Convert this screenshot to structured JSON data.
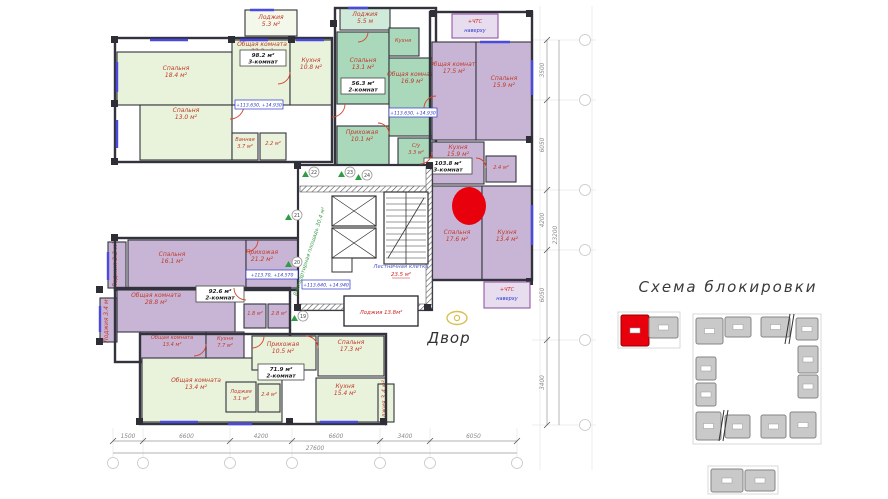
{
  "palette": {
    "pale_green": "#e9f2da",
    "teal": "#a9d8bb",
    "yellow": "#ffd355",
    "purple": "#c8b5d5",
    "wall": "#33333d",
    "label_red": "#c03a2b",
    "blue_note": "#2a35c9",
    "dim_gray": "#8a8a8a",
    "marker_red": "#e8000d",
    "block_gray": "#c9c9c9",
    "block_border": "#858585",
    "window_blue": "#4a4ae0",
    "door_red": "#d4452c",
    "green_arrow": "#2e9e44",
    "eye_yellow": "#d8c050"
  },
  "scheme": {
    "title": "Схема блокировки"
  },
  "courtyard": {
    "label": "Двор"
  },
  "floorplan": {
    "apartments": [
      {
        "id": "98-2",
        "color": "pale_green",
        "ox": 115,
        "oy": 38,
        "ow": 217,
        "oh": 124,
        "info": {
          "area": "98.2 м²",
          "type": "3-комнат",
          "x": 240,
          "y": 50,
          "w": 46,
          "h": 16
        },
        "rooms": [
          {
            "name": "Спальня",
            "area": "18.4 м²",
            "x": 117,
            "y": 52,
            "w": 115,
            "h": 53,
            "lx": 176,
            "ly": 70
          },
          {
            "name": "Общая комната",
            "area": "23.2 м²",
            "x": 232,
            "y": 40,
            "w": 58,
            "h": 65,
            "lx": 262,
            "ly": 46
          },
          {
            "name": "Кухня",
            "area": "10.8 м²",
            "x": 290,
            "y": 40,
            "w": 42,
            "h": 65,
            "lx": 311,
            "ly": 62
          },
          {
            "name": "Спальня",
            "area": "13.0 м²",
            "x": 140,
            "y": 105,
            "w": 92,
            "h": 55,
            "lx": 186,
            "ly": 112
          },
          {
            "name": "Ванная",
            "area": "3.7 м²",
            "x": 232,
            "y": 133,
            "w": 26,
            "h": 27,
            "lx": 245,
            "ly": 141,
            "small": true
          },
          {
            "name": "",
            "area": "2.2 м²",
            "x": 260,
            "y": 133,
            "w": 26,
            "h": 27,
            "lx": 273,
            "ly": 142,
            "small": true
          },
          {
            "name": "Лоджия",
            "area": "5.3 м²",
            "x": 245,
            "y": 10,
            "w": 52,
            "h": 26,
            "lx": 271,
            "ly": 19,
            "light": true
          }
        ]
      },
      {
        "id": "56-3",
        "color": "teal",
        "ox": 335,
        "oy": 8,
        "ow": 101,
        "oh": 159,
        "info": {
          "area": "56.3 м²",
          "type": "2-комнат",
          "x": 341,
          "y": 78,
          "w": 44,
          "h": 16
        },
        "rooms": [
          {
            "name": "Лоджия",
            "area": "5.5 м",
            "x": 340,
            "y": 8,
            "w": 50,
            "h": 22,
            "lx": 365,
            "ly": 16,
            "light": true
          },
          {
            "name": "Спальня",
            "area": "13.1 м²",
            "x": 337,
            "y": 32,
            "w": 52,
            "h": 72,
            "lx": 363,
            "ly": 62
          },
          {
            "name": "Кухня",
            "area": "",
            "x": 389,
            "y": 28,
            "w": 30,
            "h": 28,
            "lx": 403,
            "ly": 42,
            "small": true
          },
          {
            "name": "Общая комната",
            "area": "16.9 м²",
            "x": 389,
            "y": 58,
            "w": 47,
            "h": 78,
            "lx": 412,
            "ly": 76
          },
          {
            "name": "Прихожая",
            "area": "10.1 м²",
            "x": 337,
            "y": 126,
            "w": 52,
            "h": 40,
            "lx": 362,
            "ly": 134
          },
          {
            "name": "С/у",
            "area": "3.3 м²",
            "x": 398,
            "y": 138,
            "w": 38,
            "h": 28,
            "lx": 416,
            "ly": 147,
            "small": true
          }
        ]
      },
      {
        "id": "103-8",
        "color": "purple",
        "ox": 430,
        "oy": 12,
        "ow": 102,
        "oh": 268,
        "info": {
          "area": "103.8 м²",
          "type": "3-комнат",
          "x": 424,
          "y": 158,
          "w": 48,
          "h": 16
        },
        "rooms": [
          {
            "name": "Общая комната",
            "area": "17.5 м²",
            "x": 432,
            "y": 42,
            "w": 44,
            "h": 98,
            "lx": 454,
            "ly": 66
          },
          {
            "name": "Спальня",
            "area": "15.9 м²",
            "x": 476,
            "y": 42,
            "w": 56,
            "h": 98,
            "lx": 504,
            "ly": 80
          },
          {
            "name": "Кухня",
            "area": "15.9 м²",
            "x": 432,
            "y": 142,
            "w": 52,
            "h": 42,
            "lx": 458,
            "ly": 149
          },
          {
            "name": "",
            "area": "2.4 м²",
            "x": 486,
            "y": 156,
            "w": 30,
            "h": 26,
            "lx": 501,
            "ly": 166,
            "small": true
          },
          {
            "name": "Спальня",
            "area": "17.6 м²",
            "x": 432,
            "y": 186,
            "w": 50,
            "h": 94,
            "lx": 457,
            "ly": 234
          },
          {
            "name": "Кухня",
            "area": "13.4 м²",
            "x": 482,
            "y": 186,
            "w": 50,
            "h": 94,
            "lx": 507,
            "ly": 234
          }
        ]
      },
      {
        "id": "e-strip",
        "color": "purple",
        "ox": 115,
        "oy": 238,
        "ow": 215,
        "oh": 52,
        "rooms": [
          {
            "name": "Спальня",
            "area": "16.1 м²",
            "x": 128,
            "y": 240,
            "w": 118,
            "h": 48,
            "lx": 172,
            "ly": 256
          },
          {
            "name": "Прихожая",
            "area": "21.2 м²",
            "x": 246,
            "y": 240,
            "w": 82,
            "h": 48,
            "lx": 262,
            "ly": 254
          },
          {
            "name": "Лоджия",
            "area": "3.3 м²",
            "x": 108,
            "y": 242,
            "w": 18,
            "h": 46,
            "vert": true,
            "lx": 117,
            "ly": 265
          }
        ]
      },
      {
        "id": "92-6",
        "color": "purple",
        "ox": 115,
        "oy": 288,
        "ow": 175,
        "oh": 74,
        "info": {
          "area": "92.6 м²",
          "type": "2-комнат",
          "x": 196,
          "y": 286,
          "w": 48,
          "h": 16
        },
        "rooms": [
          {
            "name": "Общая комната",
            "area": "28.8 м²",
            "x": 117,
            "y": 290,
            "w": 118,
            "h": 42,
            "lx": 156,
            "ly": 297
          },
          {
            "name": "Общая комната",
            "area": "13.4 м²",
            "x": 140,
            "y": 332,
            "w": 66,
            "h": 28,
            "lx": 172,
            "ly": 339,
            "small": true
          },
          {
            "name": "Кухня",
            "area": "7.7 м²",
            "x": 206,
            "y": 332,
            "w": 38,
            "h": 28,
            "lx": 225,
            "ly": 340,
            "small": true
          },
          {
            "name": "",
            "area": "1.8 м²",
            "x": 244,
            "y": 304,
            "w": 22,
            "h": 24,
            "lx": 255,
            "ly": 312,
            "small": true
          },
          {
            "name": "",
            "area": "2.8 м²",
            "x": 268,
            "y": 304,
            "w": 22,
            "h": 24,
            "lx": 279,
            "ly": 312,
            "small": true
          },
          {
            "name": "Лоджия",
            "area": "3.4 м²",
            "x": 100,
            "y": 298,
            "w": 17,
            "h": 44,
            "vert": true,
            "lx": 108,
            "ly": 320
          }
        ]
      },
      {
        "id": "71-9",
        "color": "pale_green",
        "ox": 140,
        "oy": 334,
        "ow": 246,
        "oh": 90,
        "info": {
          "area": "71.9 м²",
          "type": "2-комнат",
          "x": 258,
          "y": 364,
          "w": 46,
          "h": 16
        },
        "rooms": [
          {
            "name": "Общая комната",
            "area": "13.4 м²",
            "x": 142,
            "y": 358,
            "w": 140,
            "h": 64,
            "lx": 196,
            "ly": 382
          },
          {
            "name": "Прихожая",
            "area": "10.5 м²",
            "x": 252,
            "y": 336,
            "w": 64,
            "h": 34,
            "lx": 283,
            "ly": 346
          },
          {
            "name": "Спальня",
            "area": "17.3 м²",
            "x": 318,
            "y": 336,
            "w": 66,
            "h": 40,
            "lx": 351,
            "ly": 344
          },
          {
            "name": "Кухня",
            "area": "15.4 м²",
            "x": 316,
            "y": 378,
            "w": 70,
            "h": 44,
            "lx": 345,
            "ly": 388
          },
          {
            "name": "Лоджия",
            "area": "3.1 м²",
            "x": 226,
            "y": 382,
            "w": 30,
            "h": 30,
            "lx": 241,
            "ly": 393,
            "small": true
          },
          {
            "name": "",
            "area": "2.4 м²",
            "x": 258,
            "y": 384,
            "w": 22,
            "h": 28,
            "lx": 269,
            "ly": 393,
            "small": true
          },
          {
            "name": "Лоджия",
            "area": "3.4 м²",
            "x": 378,
            "y": 384,
            "w": 16,
            "h": 38,
            "vert": true,
            "lx": 386,
            "ly": 403
          }
        ]
      }
    ],
    "elevation_notes": [
      {
        "text": "+113.630, +14.930",
        "x": 235,
        "y": 100,
        "w": 48,
        "h": 9
      },
      {
        "text": "+113.630, +14.930",
        "x": 389,
        "y": 108,
        "w": 48,
        "h": 9
      },
      {
        "text": "+113.640, +14.940",
        "x": 302,
        "y": 280,
        "w": 48,
        "h": 9
      },
      {
        "text": "+113.70, +14.570",
        "x": 246,
        "y": 270,
        "w": 52,
        "h": 9
      }
    ],
    "hatch_notes": [
      {
        "line1": "+ЧТС",
        "line2": "наверху",
        "x": 452,
        "y": 14,
        "w": 46,
        "h": 24
      },
      {
        "line1": "+ЧТС",
        "line2": "наверху",
        "x": 484,
        "y": 282,
        "w": 46,
        "h": 26
      }
    ],
    "core": {
      "common_area_label": "Внеквартирная площадь 30.4 м²",
      "stair_label_1": "Лестничная клетка",
      "stair_label_2": "23.5 м²",
      "lobby_label": "Лоджия 13.8м²"
    },
    "unit_markers": [
      {
        "num": "19",
        "x": 303,
        "y": 316
      },
      {
        "num": "20",
        "x": 297,
        "y": 262
      },
      {
        "num": "21",
        "x": 297,
        "y": 215
      },
      {
        "num": "22",
        "x": 314,
        "y": 172
      },
      {
        "num": "23",
        "x": 350,
        "y": 172
      },
      {
        "num": "24",
        "x": 367,
        "y": 175
      }
    ],
    "red_marker": {
      "cx": 469,
      "cy": 206,
      "rx": 17,
      "ry": 19
    },
    "dims_bottom": {
      "ticks": [
        113,
        143,
        230,
        292,
        380,
        430,
        517
      ],
      "labels": [
        "1500",
        "6600",
        "4200",
        "6600",
        "3400",
        "6050"
      ],
      "total": "27600"
    },
    "dims_right": {
      "ticks": [
        40,
        100,
        190,
        250,
        340,
        425
      ],
      "labels": [
        "3500",
        "6050",
        "4200",
        "6050",
        "3400"
      ],
      "total": "23200"
    }
  },
  "block_scheme": {
    "blocks": [
      {
        "x": 621,
        "y": 315,
        "w": 28,
        "h": 31,
        "highlight": true
      },
      {
        "x": 649,
        "y": 317,
        "w": 29,
        "h": 21
      },
      {
        "x": 696,
        "y": 318,
        "w": 27,
        "h": 26
      },
      {
        "x": 725,
        "y": 317,
        "w": 26,
        "h": 20
      },
      {
        "x": 761,
        "y": 317,
        "w": 29,
        "h": 20
      },
      {
        "x": 796,
        "y": 318,
        "w": 22,
        "h": 22
      },
      {
        "x": 798,
        "y": 346,
        "w": 20,
        "h": 27
      },
      {
        "x": 798,
        "y": 375,
        "w": 20,
        "h": 23
      },
      {
        "x": 696,
        "y": 357,
        "w": 20,
        "h": 23
      },
      {
        "x": 696,
        "y": 383,
        "w": 20,
        "h": 23
      },
      {
        "x": 696,
        "y": 412,
        "w": 25,
        "h": 28
      },
      {
        "x": 725,
        "y": 415,
        "w": 25,
        "h": 23
      },
      {
        "x": 761,
        "y": 415,
        "w": 25,
        "h": 23
      },
      {
        "x": 790,
        "y": 412,
        "w": 26,
        "h": 26
      },
      {
        "x": 711,
        "y": 469,
        "w": 32,
        "h": 23
      },
      {
        "x": 745,
        "y": 470,
        "w": 30,
        "h": 21
      }
    ]
  }
}
